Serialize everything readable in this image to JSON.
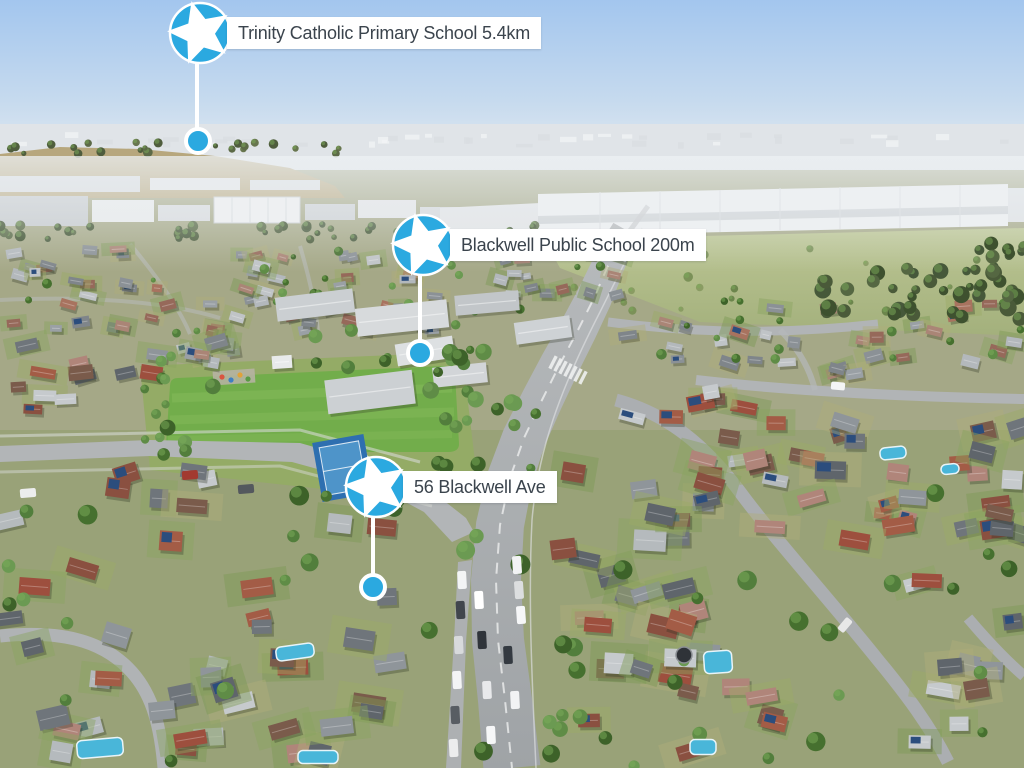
{
  "markers": [
    {
      "label": "Trinity Catholic Primary School 5.4km",
      "place": "Trinity Catholic Primary School",
      "distance": "5.4km",
      "icon": "star-pin"
    },
    {
      "label": "Blackwell Public School 200m",
      "place": "Blackwell Public School",
      "distance": "200m",
      "icon": "star-pin"
    },
    {
      "label": "56 Blackwell Ave",
      "place": "56 Blackwell Ave",
      "distance": "",
      "icon": "star-pin"
    }
  ],
  "colors": {
    "pin_blue": "#2BA9E0",
    "label_bg": "#FFFFFF",
    "label_text": "#3B444D"
  }
}
